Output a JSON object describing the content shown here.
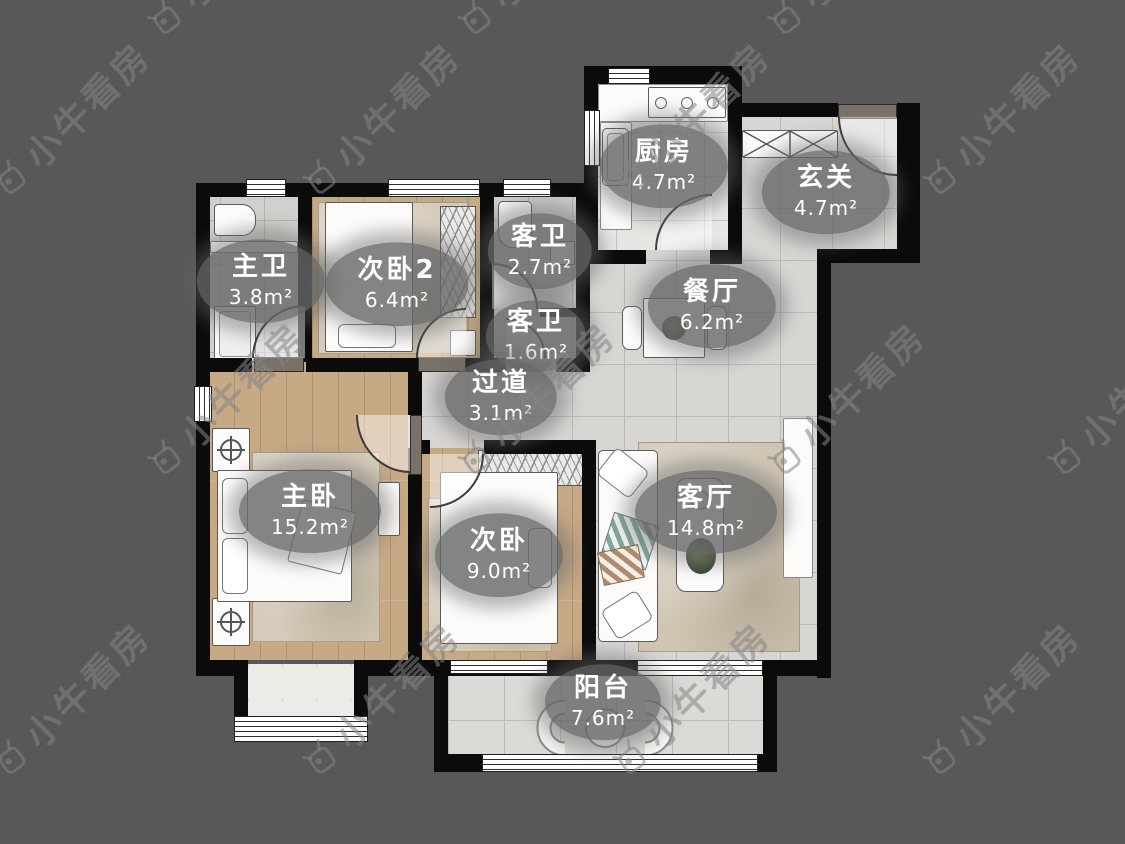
{
  "watermark": {
    "text": "小牛看房"
  },
  "rooms": [
    {
      "id": "kitchen",
      "name": "厨房",
      "area": "4.7m²"
    },
    {
      "id": "hallway",
      "name": "玄关",
      "area": "4.7m²"
    },
    {
      "id": "master-bath",
      "name": "主卫",
      "area": "3.8m²"
    },
    {
      "id": "bedroom2",
      "name": "次卧2",
      "area": "6.4m²"
    },
    {
      "id": "guest-bath",
      "name": "客卫",
      "area": "2.7m²"
    },
    {
      "id": "guest-bath-small",
      "name": "客卫",
      "area": "1.6m²"
    },
    {
      "id": "dining",
      "name": "餐厅",
      "area": "6.2m²"
    },
    {
      "id": "corridor",
      "name": "过道",
      "area": "3.1m²"
    },
    {
      "id": "master-bedroom",
      "name": "主卧",
      "area": "15.2m²"
    },
    {
      "id": "bedroom",
      "name": "次卧",
      "area": "9.0m²"
    },
    {
      "id": "living",
      "name": "客厅",
      "area": "14.8m²"
    },
    {
      "id": "balcony",
      "name": "阳台",
      "area": "7.6m²"
    }
  ],
  "colors": {
    "background": "#58585a",
    "wall": "#0b0b0b",
    "label_pill": "#666666",
    "label_text": "#ffffff",
    "wood_floor": "#c6a985",
    "tile_floor": "#d8d6d3",
    "balcony_floor": "#dcdad6",
    "watermark": "#858585"
  }
}
